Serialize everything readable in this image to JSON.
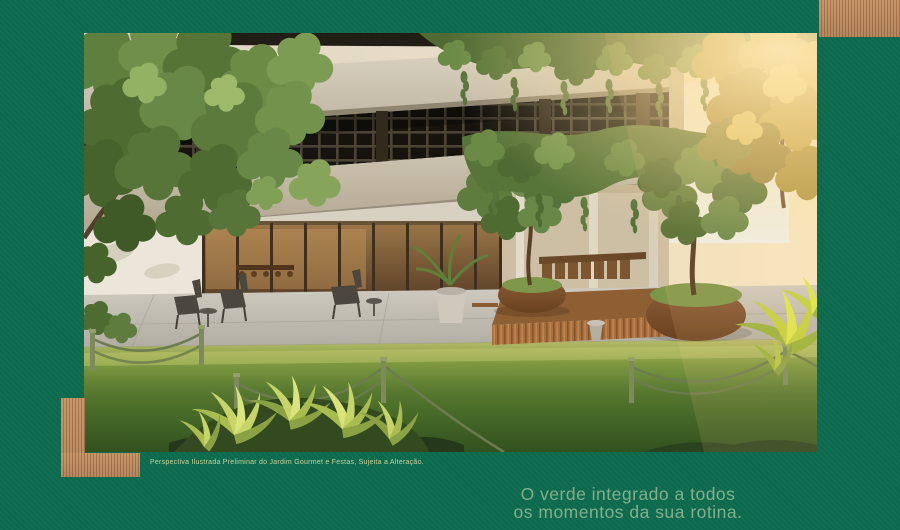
{
  "colors": {
    "background": "#0d6b4e",
    "tagline": "#83ae8d",
    "caption": "#c6d29d",
    "wood_light": "#dcb084",
    "wood_mid": "#c28d5e",
    "wood_dark": "#a16a41"
  },
  "caption": {
    "text": "Perspectiva Ilustrada Preliminar do Jardim Gourmet e Festas, Sujeita a Alteração."
  },
  "tagline": {
    "line1": "O verde integrado a todos",
    "line2": "os momentos da sua rotina."
  }
}
